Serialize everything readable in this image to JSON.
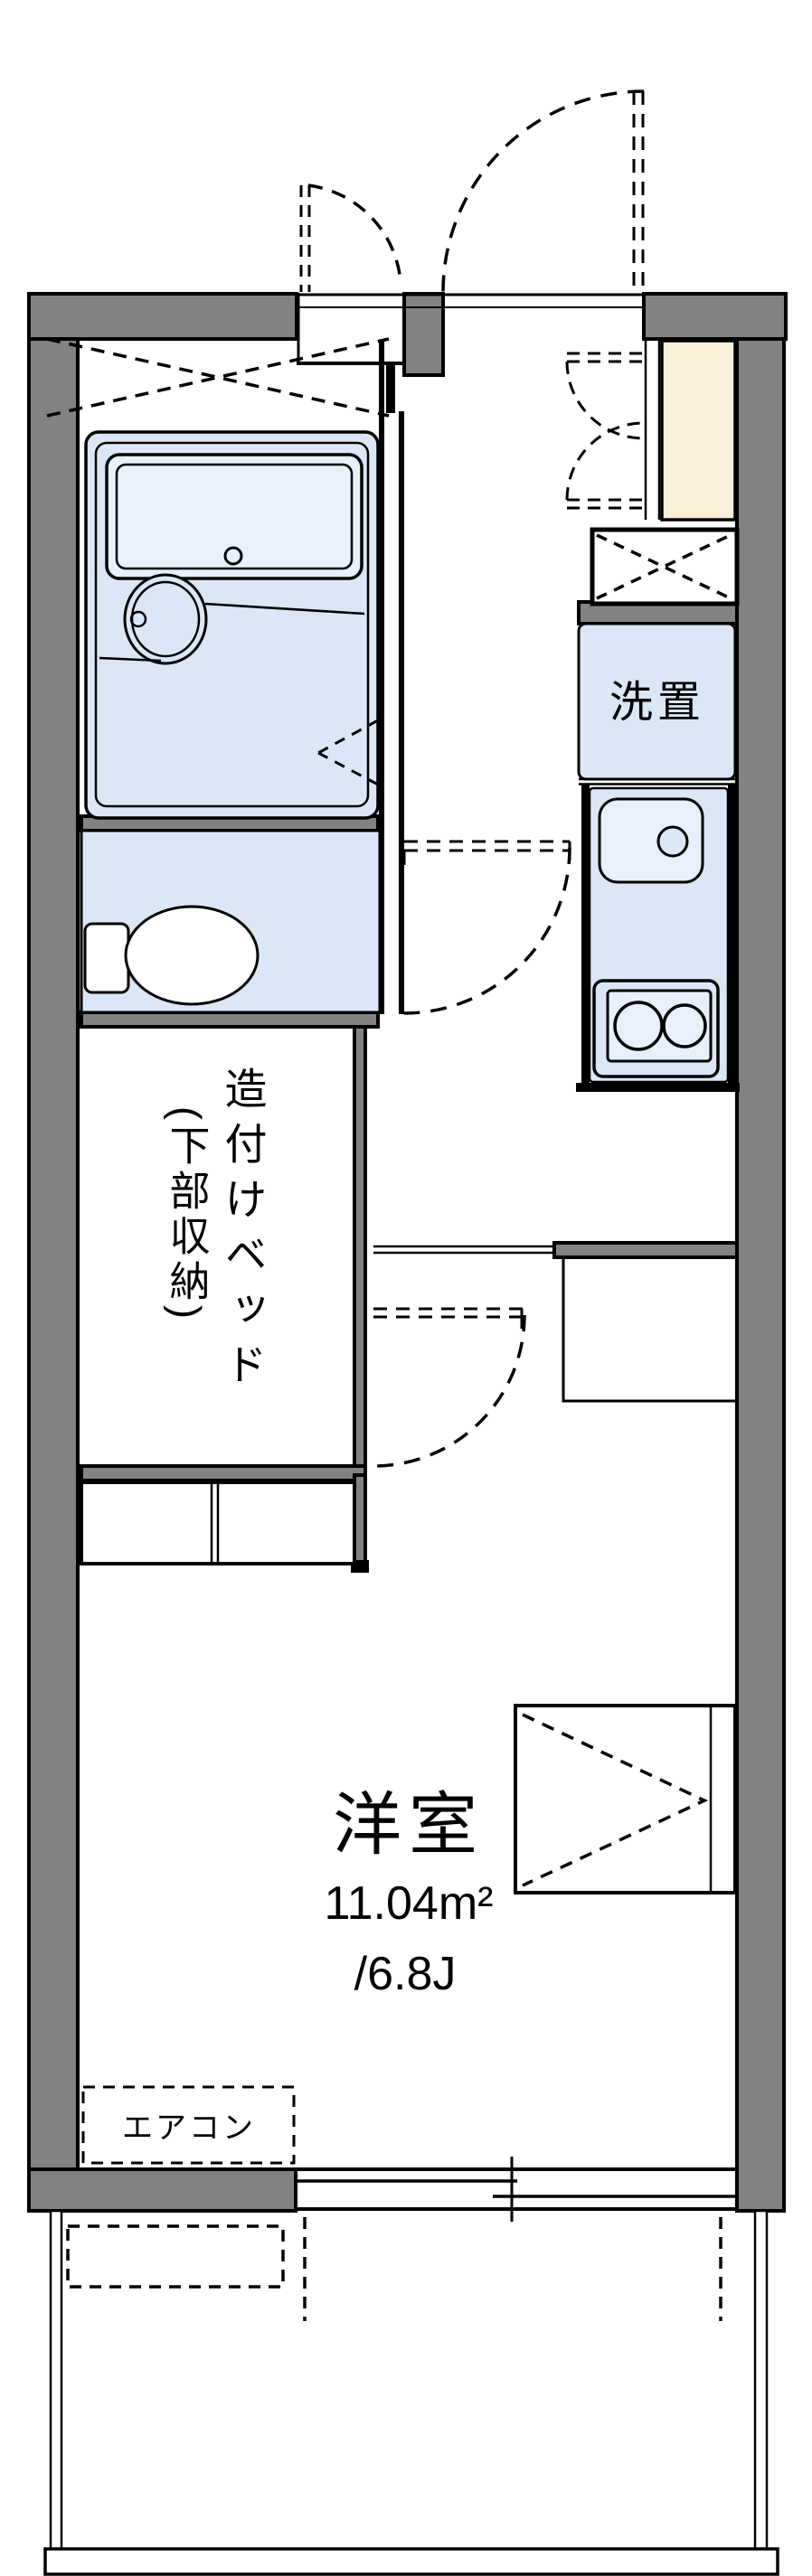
{
  "document": {
    "type": "japanese-apartment-floor-plan"
  },
  "labels": {
    "washer": "洗置",
    "bed_line1": "造付けベッド",
    "bed_line2": "(下部収納)",
    "room_name": "洋室",
    "room_area_m2": "11.04m²",
    "room_area_jo": "/6.8J",
    "aircon": "エアコン"
  },
  "room_info": {
    "name": "洋室",
    "area_sqm": 11.04,
    "area_tatami": "6.8J"
  },
  "colors": {
    "wall_gray": "#828282",
    "line_black": "#000000",
    "fixture_blue": "#dbe7f7",
    "fixture_blue_light": "#e7f0fb",
    "cabinet_cream": "#faefd9",
    "background": "#ffffff"
  }
}
